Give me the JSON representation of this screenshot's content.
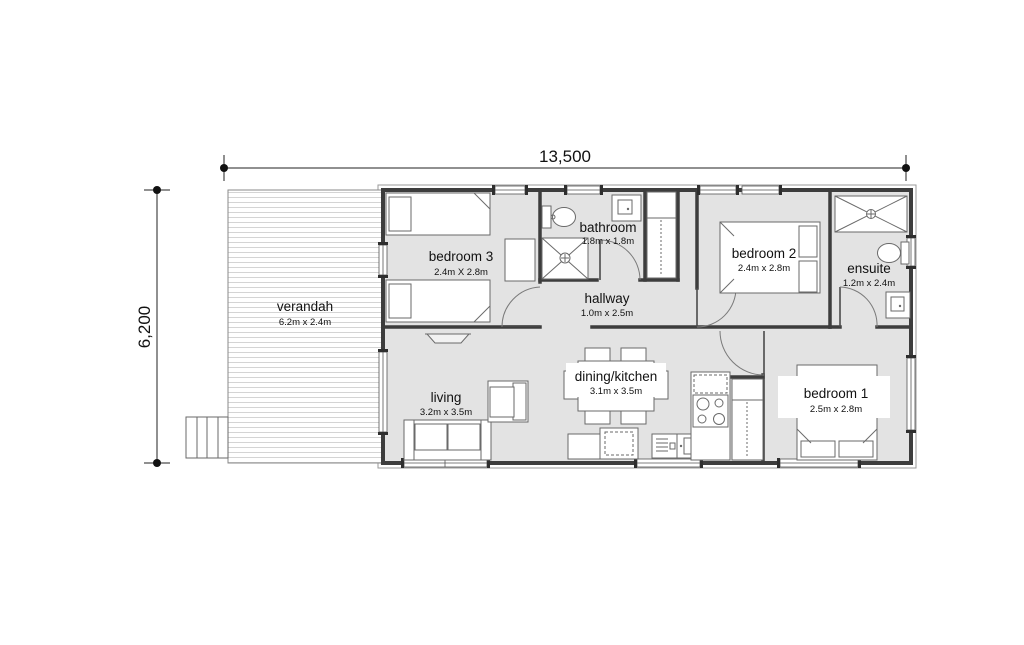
{
  "title": "floor-plan",
  "dimensions": {
    "width_label": "13,500",
    "depth_label": "6,200"
  },
  "rooms": {
    "verandah": {
      "name": "verandah",
      "dims": "6.2m x 2.4m"
    },
    "bedroom3": {
      "name": "bedroom 3",
      "dims": "2.4m X 2.8m"
    },
    "bathroom": {
      "name": "bathroom",
      "dims": "1.8m x 1.8m"
    },
    "bedroom2": {
      "name": "bedroom 2",
      "dims": "2.4m x 2.8m"
    },
    "ensuite": {
      "name": "ensuite",
      "dims": "1.2m x  2.4m"
    },
    "hallway": {
      "name": "hallway",
      "dims": "1.0m x 2.5m"
    },
    "living": {
      "name": "living",
      "dims": "3.2m x 3.5m"
    },
    "dining_kitchen": {
      "name": "dining/kitchen",
      "dims": "3.1m x 3.5m"
    },
    "bedroom1": {
      "name": "bedroom 1",
      "dims": "2.5m x 2.8m"
    }
  },
  "colors": {
    "background": "#ffffff",
    "floor": "#e3e3e3",
    "wall": "#3d3d3d",
    "deck_hatch": "#d4d4d4",
    "dimension": "#222222"
  }
}
